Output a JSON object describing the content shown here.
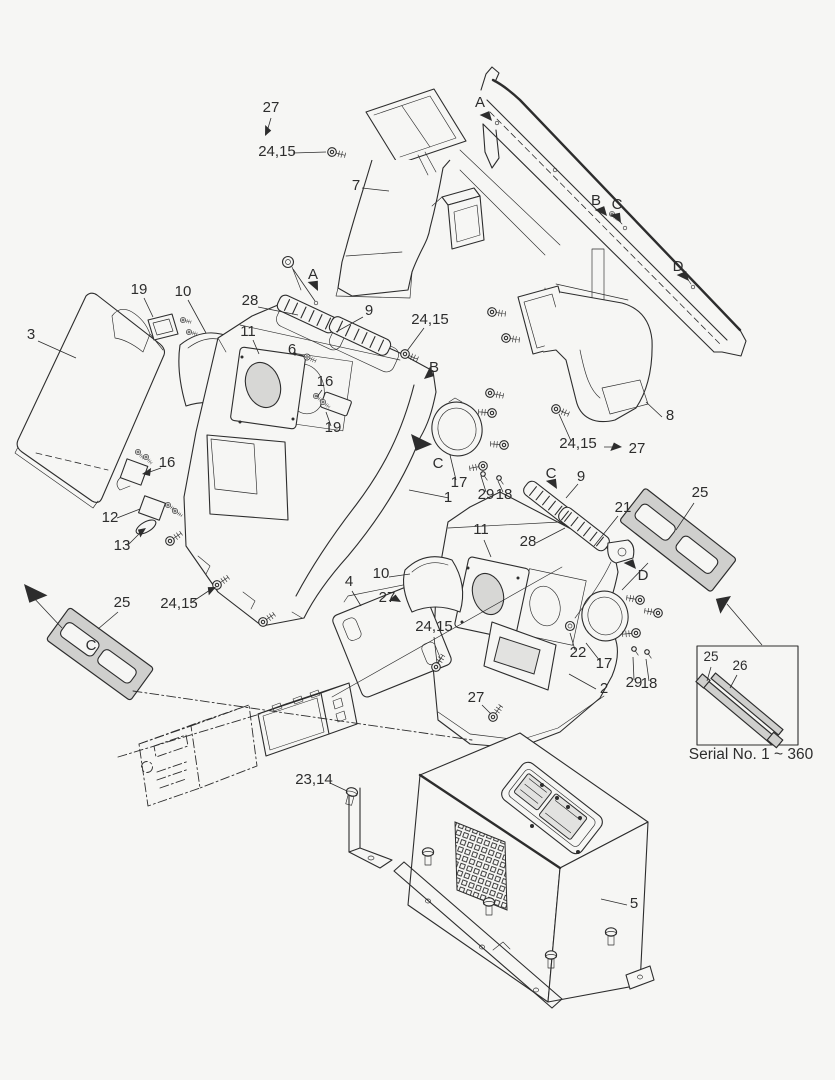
{
  "diagram": {
    "kind": "exploded-parts-diagram",
    "caption": "Serial No. 1 ~ 360"
  },
  "colors": {
    "background": "#f6f6f4",
    "ink": "#2d2d2d",
    "shade": "#d7d7d5",
    "bezel": "#cfcfcd"
  },
  "callouts": [
    {
      "text": "27",
      "x": 271,
      "y": 112
    },
    {
      "text": "24,15",
      "x": 277,
      "y": 156
    },
    {
      "text": "7",
      "x": 356,
      "y": 190
    },
    {
      "text": "A",
      "x": 480,
      "y": 107
    },
    {
      "text": "B",
      "x": 596,
      "y": 205
    },
    {
      "text": "C",
      "x": 617,
      "y": 209
    },
    {
      "text": "D",
      "x": 678,
      "y": 271
    },
    {
      "text": "3",
      "x": 31,
      "y": 339
    },
    {
      "text": "19",
      "x": 139,
      "y": 294
    },
    {
      "text": "10",
      "x": 183,
      "y": 296
    },
    {
      "text": "28",
      "x": 250,
      "y": 305
    },
    {
      "text": "11",
      "x": 248,
      "y": 336
    },
    {
      "text": "6",
      "x": 292,
      "y": 354
    },
    {
      "text": "9",
      "x": 369,
      "y": 315
    },
    {
      "text": "A",
      "x": 313,
      "y": 279
    },
    {
      "text": "24,15",
      "x": 430,
      "y": 324
    },
    {
      "text": "B",
      "x": 434,
      "y": 372
    },
    {
      "text": "16",
      "x": 325,
      "y": 386
    },
    {
      "text": "19",
      "x": 333,
      "y": 432
    },
    {
      "text": "16",
      "x": 167,
      "y": 467
    },
    {
      "text": "12",
      "x": 110,
      "y": 522
    },
    {
      "text": "13",
      "x": 122,
      "y": 550
    },
    {
      "text": "C",
      "x": 438,
      "y": 468
    },
    {
      "text": "17",
      "x": 459,
      "y": 487
    },
    {
      "text": "29",
      "x": 486,
      "y": 499
    },
    {
      "text": "18",
      "x": 504,
      "y": 499
    },
    {
      "text": "1",
      "x": 448,
      "y": 502
    },
    {
      "text": "8",
      "x": 670,
      "y": 420
    },
    {
      "text": "24,15",
      "x": 578,
      "y": 448
    },
    {
      "text": "27",
      "x": 637,
      "y": 453
    },
    {
      "text": "C",
      "x": 551,
      "y": 478
    },
    {
      "text": "9",
      "x": 581,
      "y": 481
    },
    {
      "text": "21",
      "x": 623,
      "y": 512
    },
    {
      "text": "25",
      "x": 700,
      "y": 497
    },
    {
      "text": "11",
      "x": 481,
      "y": 534
    },
    {
      "text": "28",
      "x": 528,
      "y": 546
    },
    {
      "text": "D",
      "x": 643,
      "y": 580
    },
    {
      "text": "10",
      "x": 381,
      "y": 578
    },
    {
      "text": "4",
      "x": 349,
      "y": 586
    },
    {
      "text": "27",
      "x": 387,
      "y": 602
    },
    {
      "text": "24,15",
      "x": 434,
      "y": 631
    },
    {
      "text": "22",
      "x": 578,
      "y": 657
    },
    {
      "text": "17",
      "x": 604,
      "y": 668
    },
    {
      "text": "2",
      "x": 604,
      "y": 693
    },
    {
      "text": "29",
      "x": 634,
      "y": 687
    },
    {
      "text": "18",
      "x": 649,
      "y": 688
    },
    {
      "text": "25",
      "x": 122,
      "y": 607
    },
    {
      "text": "24,15",
      "x": 179,
      "y": 608
    },
    {
      "text": "C",
      "x": 91,
      "y": 650
    },
    {
      "text": "27",
      "x": 476,
      "y": 702
    },
    {
      "text": "23,14",
      "x": 314,
      "y": 784
    },
    {
      "text": "5",
      "x": 634,
      "y": 908
    },
    {
      "text": "25",
      "x": 711,
      "y": 661,
      "small": true
    },
    {
      "text": "26",
      "x": 740,
      "y": 670,
      "small": true
    }
  ]
}
